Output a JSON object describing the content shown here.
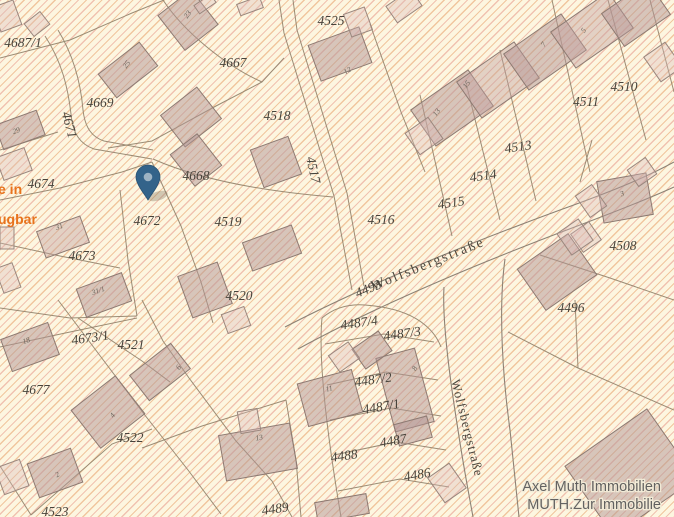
{
  "map": {
    "type": "cadastral-map",
    "background_color": "#fdf6e0",
    "hatch_colors": [
      "#f0c49b",
      "#ecb1a0"
    ],
    "boundary_color": "#96866f",
    "building_fill": "#c9b2b2",
    "label_color": "#47433b",
    "pin_color": "#33638a"
  },
  "parcels": [
    {
      "label": "4687/1"
    },
    {
      "label": "4669"
    },
    {
      "label": "4671"
    },
    {
      "label": "4667"
    },
    {
      "label": "4674"
    },
    {
      "label": "4668"
    },
    {
      "label": "4672"
    },
    {
      "label": "4519"
    },
    {
      "label": "4673"
    },
    {
      "label": "4520"
    },
    {
      "label": "4673/1"
    },
    {
      "label": "4521"
    },
    {
      "label": "4677"
    },
    {
      "label": "4522"
    },
    {
      "label": "4523"
    },
    {
      "label": "4489"
    },
    {
      "label": "4525"
    },
    {
      "label": "4518"
    },
    {
      "label": "4517"
    },
    {
      "label": "4516"
    },
    {
      "label": "4515"
    },
    {
      "label": "4514"
    },
    {
      "label": "4513"
    },
    {
      "label": "4511"
    },
    {
      "label": "4510"
    },
    {
      "label": "4508"
    },
    {
      "label": "4496"
    },
    {
      "label": "4493"
    },
    {
      "label": "4487/4"
    },
    {
      "label": "4487/3"
    },
    {
      "label": "4487/2"
    },
    {
      "label": "4487/1"
    },
    {
      "label": "4487"
    },
    {
      "label": "4488"
    },
    {
      "label": "4486"
    }
  ],
  "house_numbers": [
    {
      "label": "23"
    },
    {
      "label": "25"
    },
    {
      "label": "29"
    },
    {
      "label": "31"
    },
    {
      "label": "31/1"
    },
    {
      "label": "18"
    },
    {
      "label": "6"
    },
    {
      "label": "4"
    },
    {
      "label": "2"
    },
    {
      "label": "13"
    },
    {
      "label": "11"
    },
    {
      "label": "12"
    },
    {
      "label": "8"
    },
    {
      "label": "3"
    },
    {
      "label": "5"
    },
    {
      "label": "7"
    },
    {
      "label": "13"
    },
    {
      "label": "15"
    }
  ],
  "streets": [
    {
      "name": "Wolfsbergstraße"
    },
    {
      "name": "Wolfsbergstraße"
    }
  ],
  "overlay_text": {
    "line1": "e in",
    "line2": "ugbar",
    "color": "#e8731c"
  },
  "watermark": {
    "line1": "Axel Muth Immobilien",
    "line2": "MUTH.Zur Immobilie"
  },
  "pin": {
    "x": 148,
    "y": 202
  }
}
